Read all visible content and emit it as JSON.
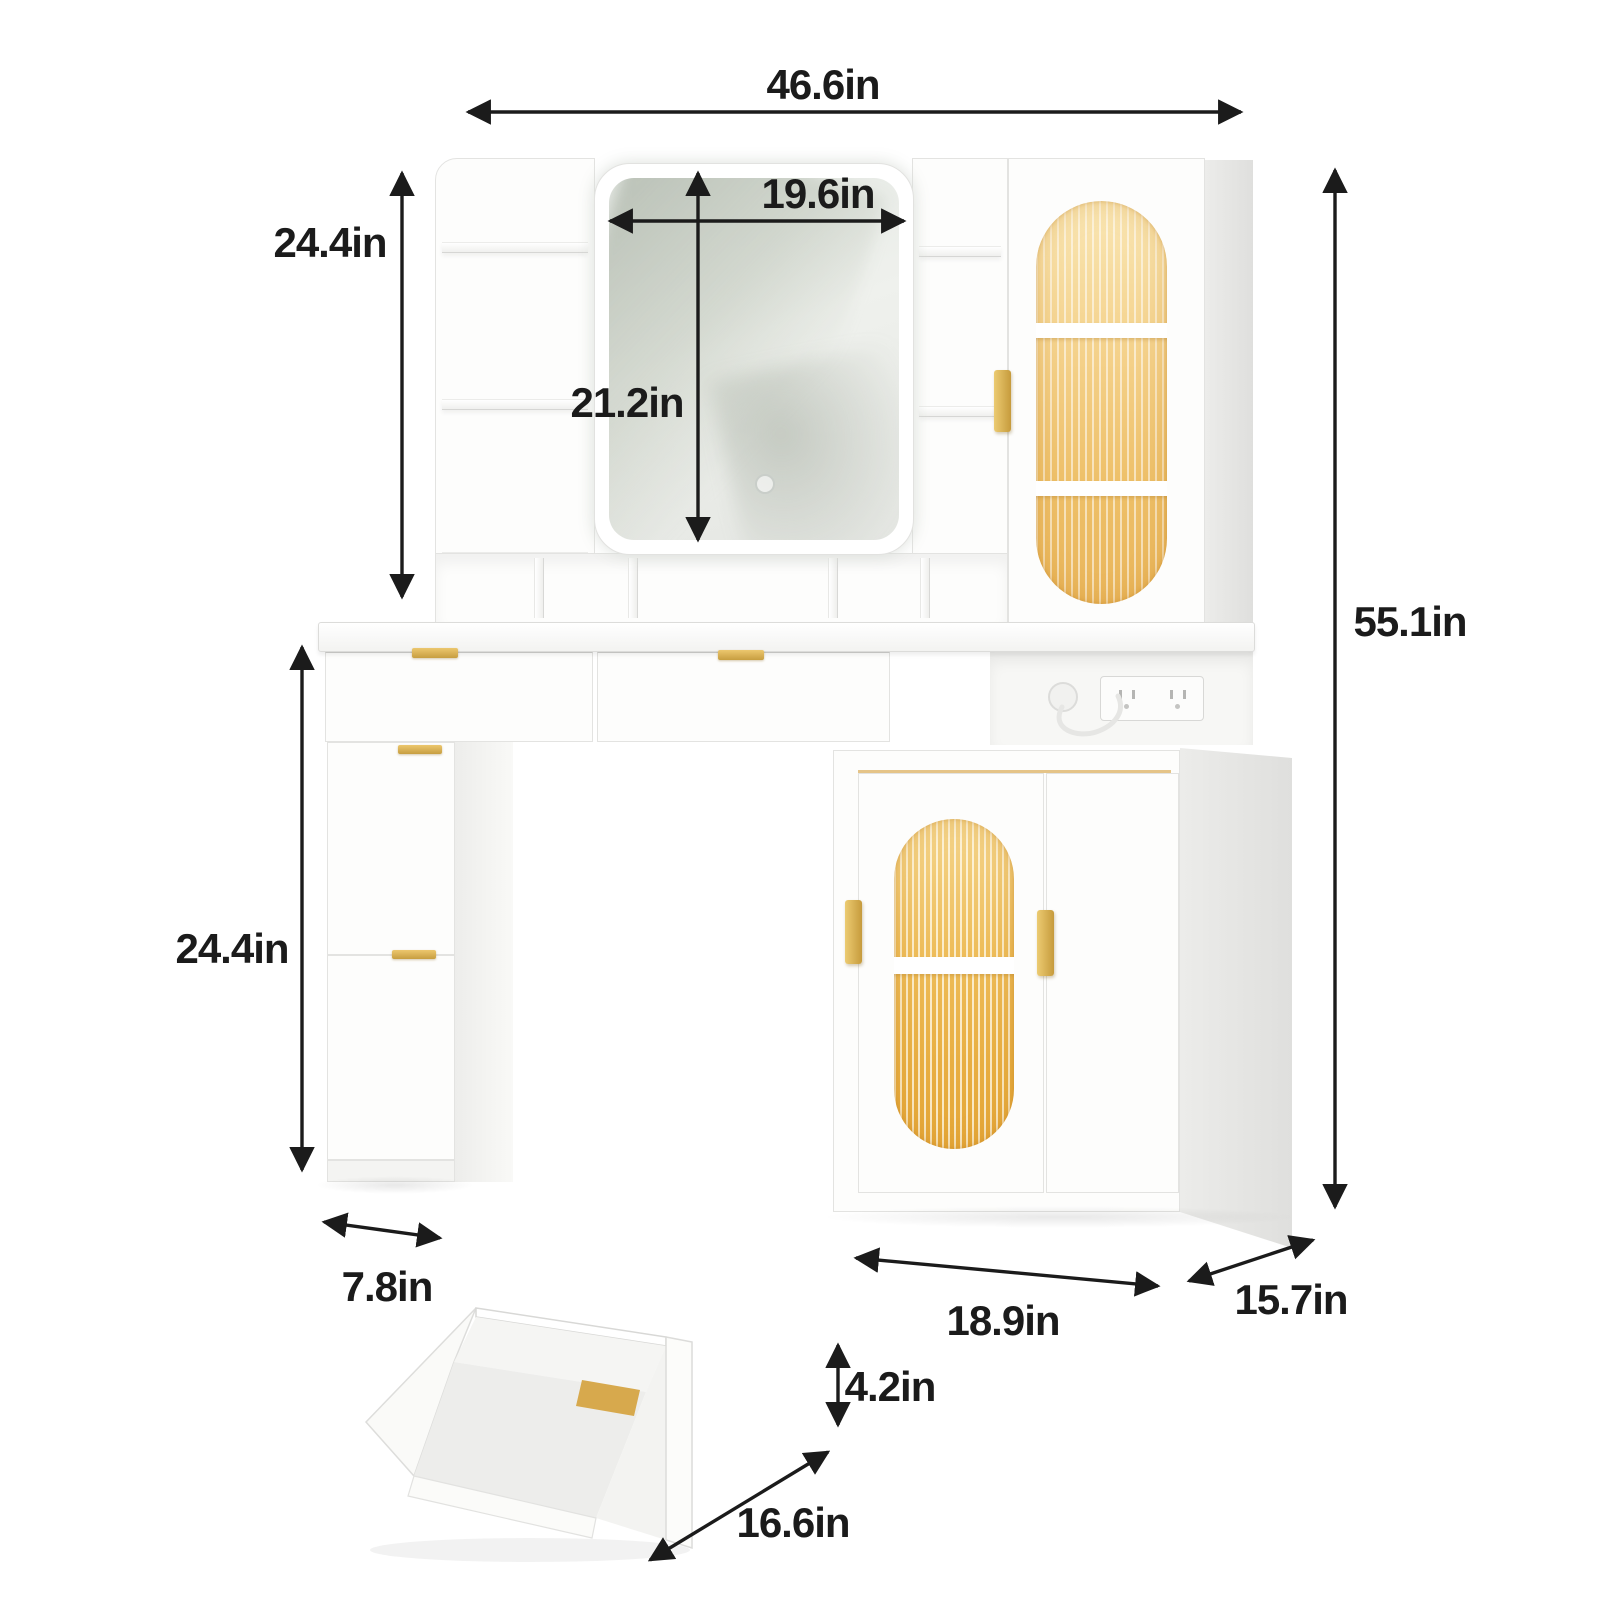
{
  "dimensions": {
    "total_width": "46.6in",
    "hutch_height": "24.4in",
    "mirror_width": "19.6in",
    "mirror_height": "21.2in",
    "total_height": "55.1in",
    "pedestal_height": "24.4in",
    "pedestal_depth": "7.8in",
    "cabinet_width": "18.9in",
    "cabinet_depth": "15.7in",
    "drawer_height": "4.2in",
    "drawer_depth": "16.6in"
  },
  "colors": {
    "background": "#ffffff",
    "furniture": "#fcfcfb",
    "side_shade": "#e9e9e7",
    "accent_gold": "#d2a44c",
    "glass_glow_light": "#f7dfa8",
    "glass_glow_deep": "#e8b95e",
    "dimension_ink": "#1b1b1b"
  }
}
